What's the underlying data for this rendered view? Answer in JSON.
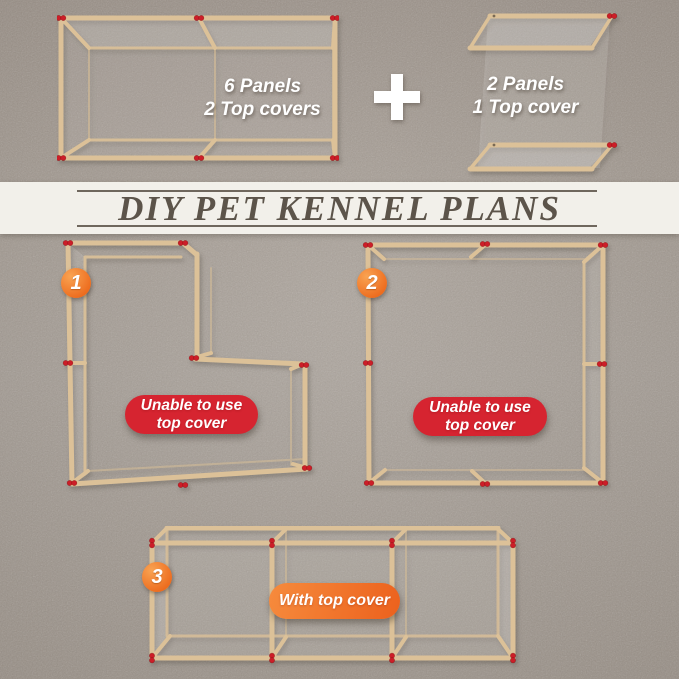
{
  "units": {
    "left": {
      "lines": [
        "6 Panels",
        "2 Top covers"
      ]
    },
    "plus": "+",
    "right": {
      "lines": [
        "2 Panels",
        "1 Top cover"
      ]
    }
  },
  "banner": {
    "title": "DIY PET KENNEL PLANS"
  },
  "plans": [
    {
      "number": "1",
      "layout": "l-shape",
      "note_lines": [
        "Unable to use",
        "top cover"
      ],
      "note_type": "warning"
    },
    {
      "number": "2",
      "layout": "square",
      "note_lines": [
        "Unable to use",
        "top cover"
      ],
      "note_type": "warning"
    },
    {
      "number": "3",
      "layout": "long-run",
      "note_lines": [
        "With top cover"
      ],
      "note_type": "positive"
    }
  ],
  "colors": {
    "background": "#a49b92",
    "banner_bg": "#f2f0ea",
    "banner_text": "#5c544a",
    "wood": "#dcc198",
    "connector_red": "#cc1e28",
    "warning_pill": "#d62430",
    "positive_pill_start": "#f68b3d",
    "positive_pill_end": "#ec611d",
    "badge_start": "#f9a352",
    "badge_end": "#ed6c1e",
    "label_text": "#ffffff"
  }
}
